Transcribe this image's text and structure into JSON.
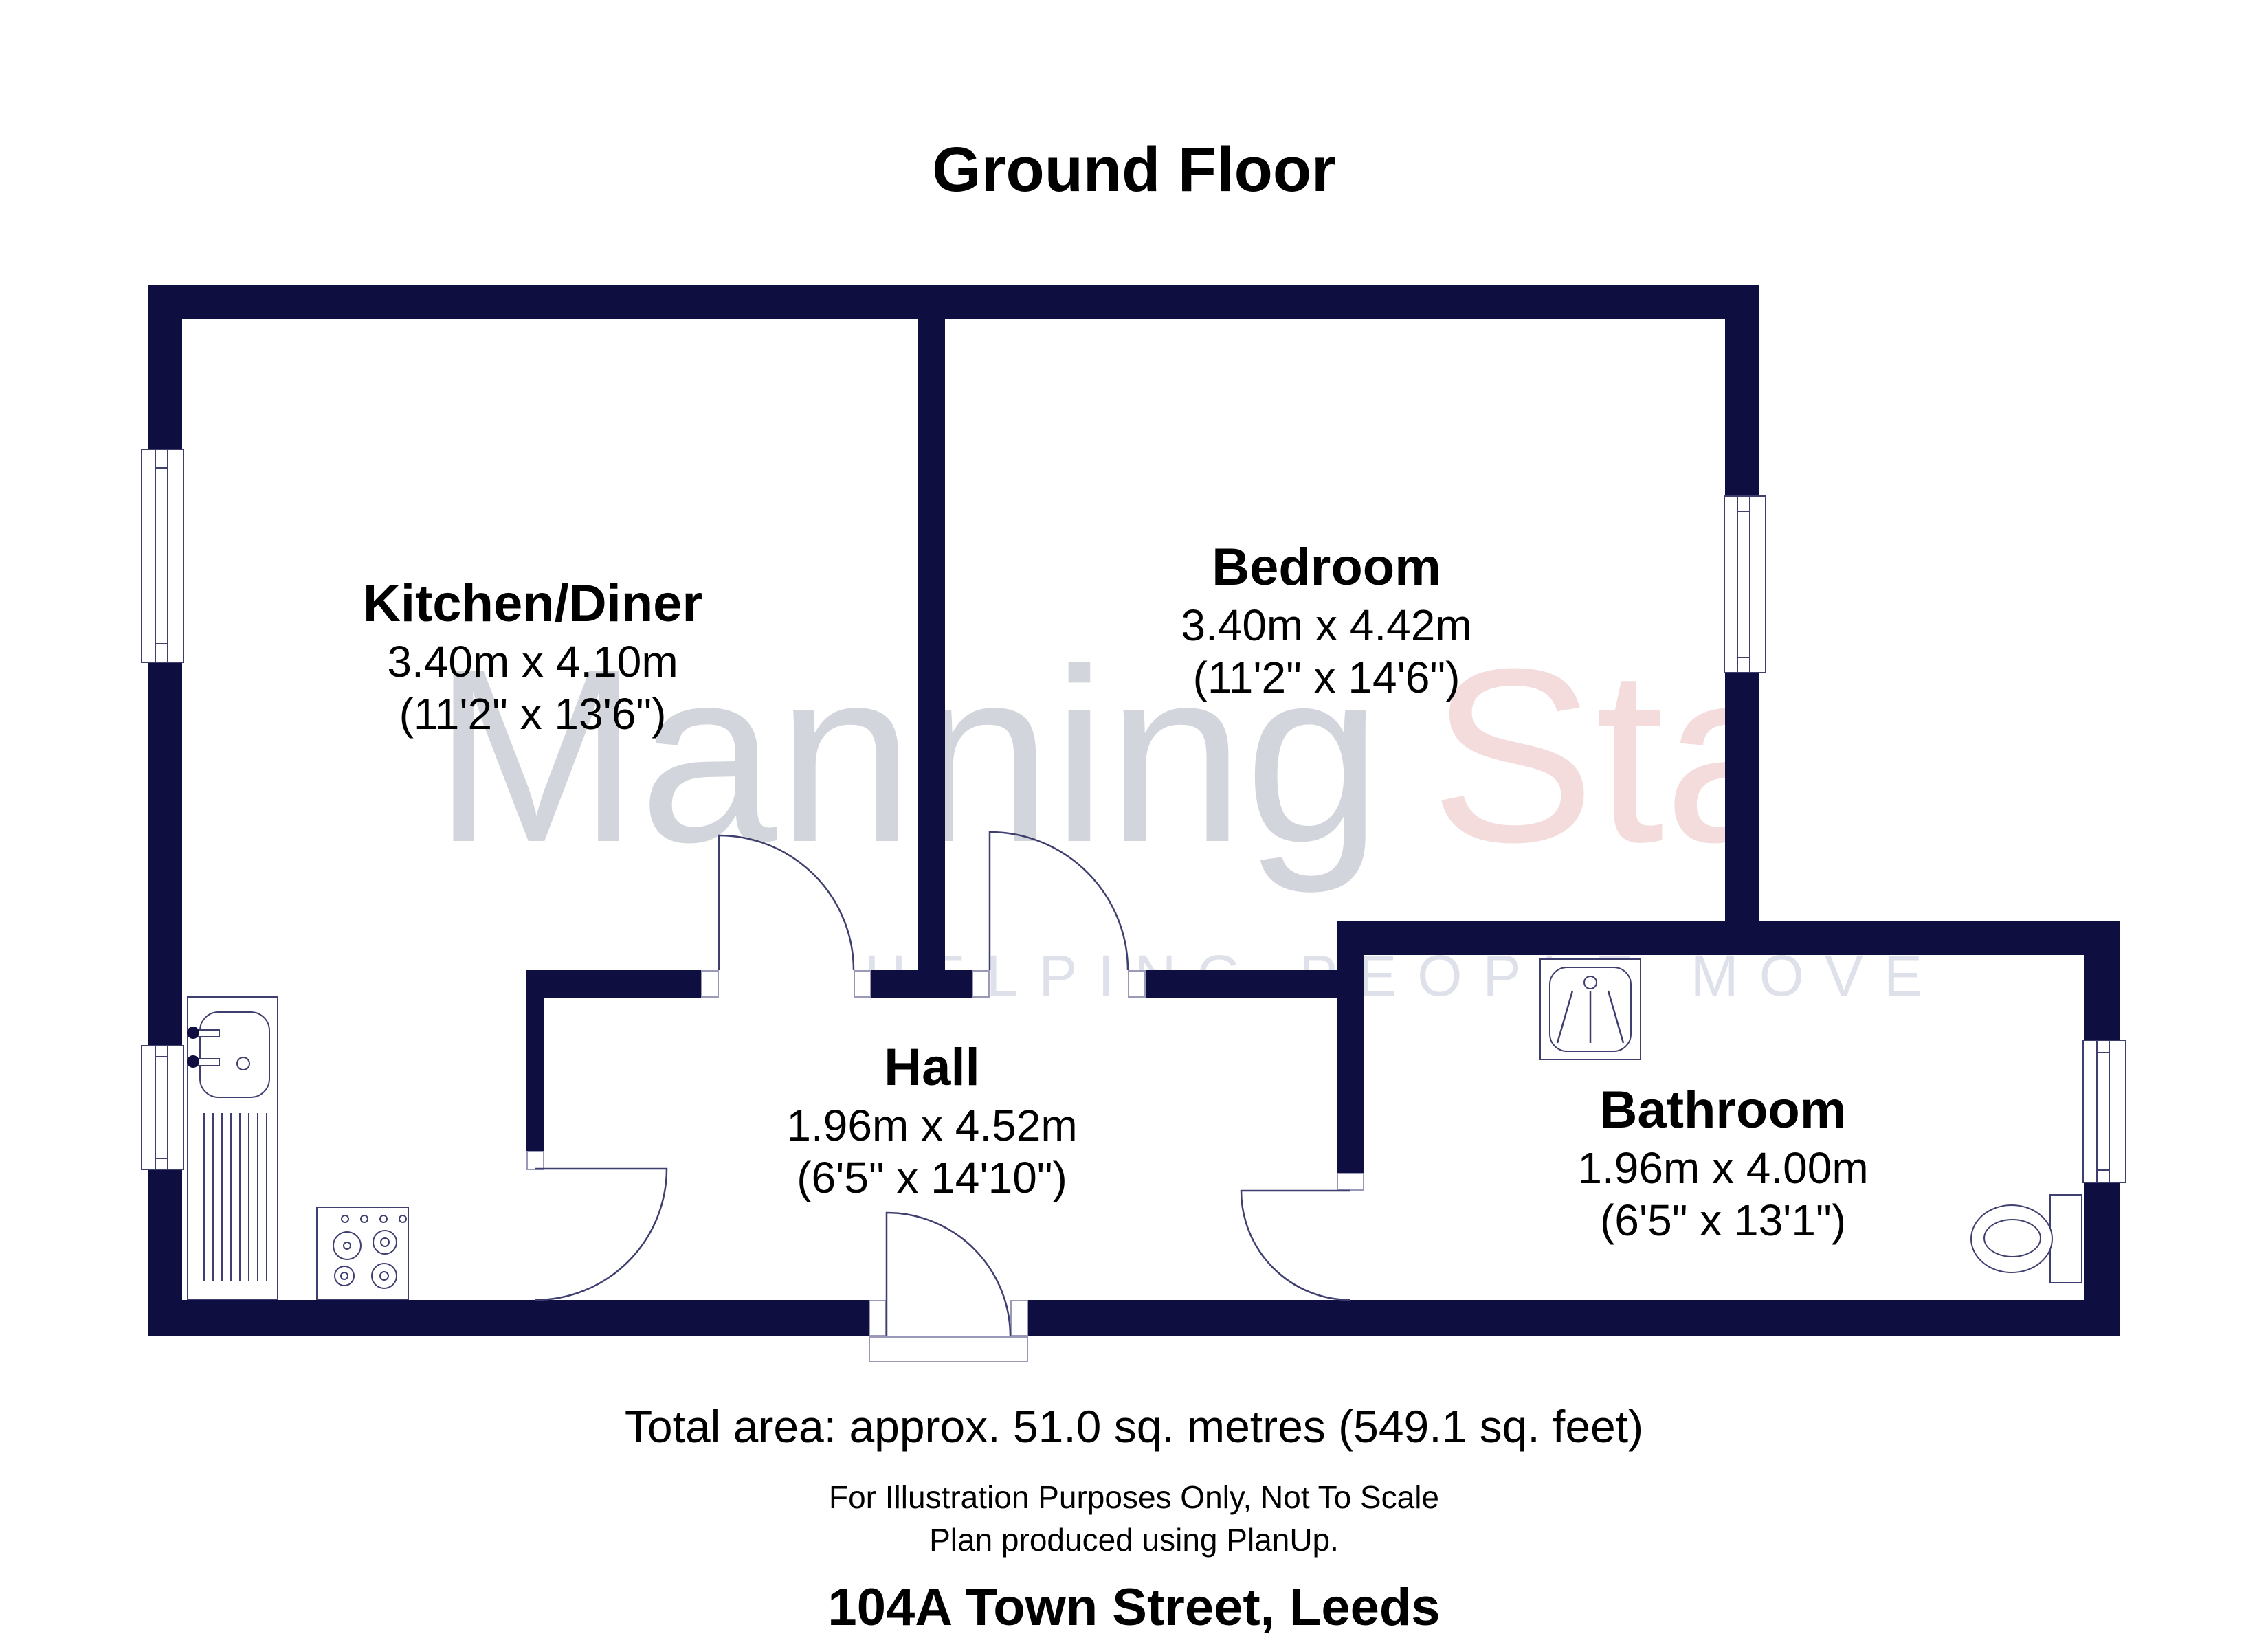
{
  "title": "Ground Floor",
  "rooms": [
    {
      "name": "Kitchen/Diner",
      "metric": "3.40m x 4.10m",
      "imperial": "(11'2\" x 13'6\")"
    },
    {
      "name": "Bedroom",
      "metric": "3.40m x 4.42m",
      "imperial": "(11'2\" x 14'6\")"
    },
    {
      "name": "Hall",
      "metric": "1.96m x 4.52m",
      "imperial": "(6'5\" x 14'10\")"
    },
    {
      "name": "Bathroom",
      "metric": "1.96m x 4.00m",
      "imperial": "(6'5\" x 13'1\")"
    }
  ],
  "watermark": {
    "brand_gray": "Manning",
    "brand_pink": "Sta",
    "tagline": "HELPING PEOPLE MOVE"
  },
  "footer": {
    "total_area": "Total area: approx. 51.0 sq. metres (549.1 sq. feet)",
    "disclaimer_line1": "For Illustration Purposes Only, Not To Scale",
    "disclaimer_line2": "Plan produced using PlanUp.",
    "address": "104A Town Street, Leeds"
  },
  "colors": {
    "wall_navy": "#0e0e40",
    "outline_navy": "#3f3f6f",
    "watermark_gray": "#d2d5dc",
    "watermark_pink": "#f4dcdc",
    "tagline_gray": "#dee1e9"
  }
}
